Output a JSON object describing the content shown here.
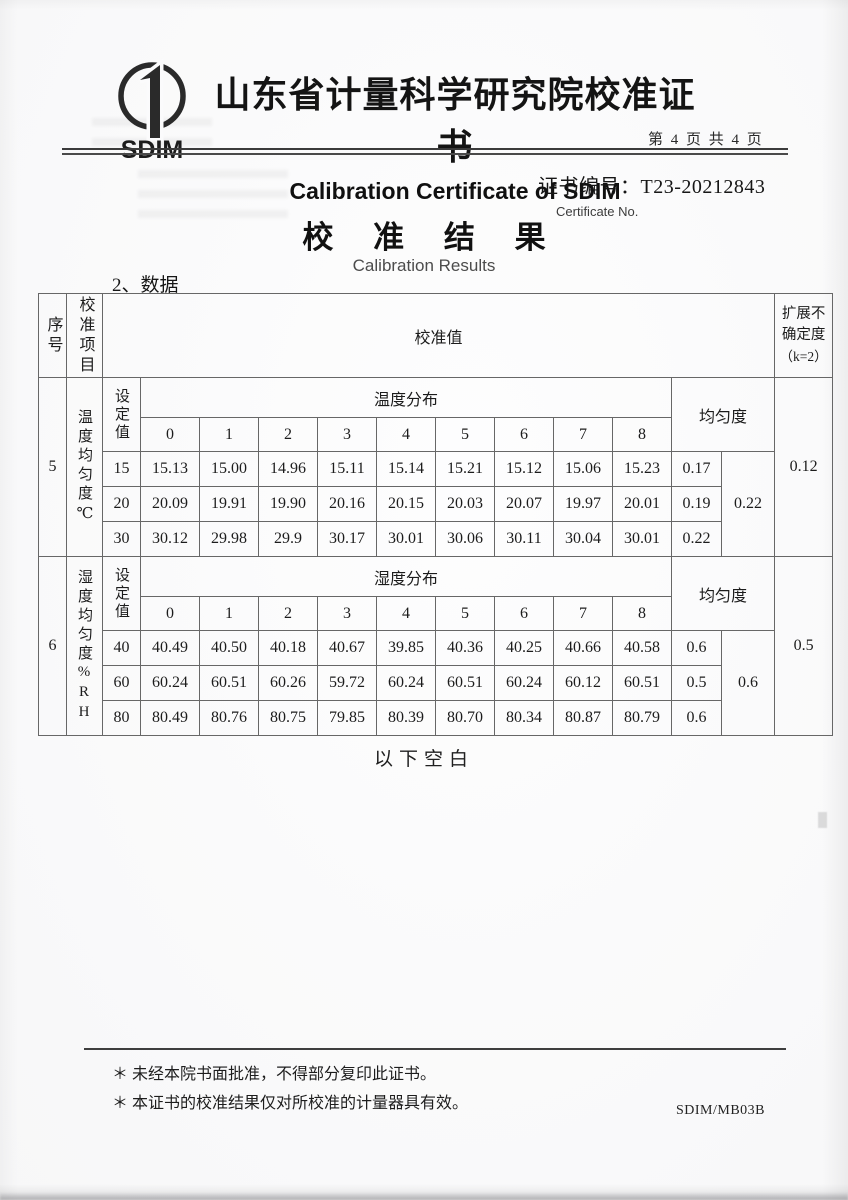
{
  "style_hints": {
    "ink": "#1f1f1f",
    "table_border": "#676767",
    "paper": "#fbfbfc"
  },
  "header": {
    "logo_text": "SDIM",
    "title_cn": "山东省计量科学研究院校准证书",
    "title_en": "Calibration Certificate of SDIM",
    "page_info": "第 4 页 共 4 页",
    "cert_no_label": "证书编号：",
    "cert_no_value": "T23-20212843",
    "cert_no_en": "Certificate No."
  },
  "results": {
    "title_cn": "校 准 结 果",
    "title_en": "Calibration Results",
    "data_label": "2、数据"
  },
  "table": {
    "headers": {
      "seq": "序号",
      "item": "校准项目",
      "value": "校准值",
      "unc_line1": "扩展不",
      "unc_line2": "确定度",
      "unc_line3": "（k=2）"
    },
    "sections": [
      {
        "seq": "5",
        "item": "温度均匀度℃",
        "set_label": "设定值",
        "dist_label": "温度分布",
        "uniformity_label": "均匀度",
        "positions": [
          "0",
          "1",
          "2",
          "3",
          "4",
          "5",
          "6",
          "7",
          "8"
        ],
        "rows": [
          {
            "set": "15",
            "values": [
              "15.13",
              "15.00",
              "14.96",
              "15.11",
              "15.14",
              "15.21",
              "15.12",
              "15.06",
              "15.23"
            ],
            "uniformity": "0.17"
          },
          {
            "set": "20",
            "values": [
              "20.09",
              "19.91",
              "19.90",
              "20.16",
              "20.15",
              "20.03",
              "20.07",
              "19.97",
              "20.01"
            ],
            "uniformity": "0.19"
          },
          {
            "set": "30",
            "values": [
              "30.12",
              "29.98",
              "29.9",
              "30.17",
              "30.01",
              "30.06",
              "30.11",
              "30.04",
              "30.01"
            ],
            "uniformity": "0.22"
          }
        ],
        "overall_uniformity": "0.22",
        "expanded_uncertainty": "0.12"
      },
      {
        "seq": "6",
        "item": "湿度均匀度%RH",
        "set_label": "设定值",
        "dist_label": "湿度分布",
        "uniformity_label": "均匀度",
        "positions": [
          "0",
          "1",
          "2",
          "3",
          "4",
          "5",
          "6",
          "7",
          "8"
        ],
        "rows": [
          {
            "set": "40",
            "values": [
              "40.49",
              "40.50",
              "40.18",
              "40.67",
              "39.85",
              "40.36",
              "40.25",
              "40.66",
              "40.58"
            ],
            "uniformity": "0.6"
          },
          {
            "set": "60",
            "values": [
              "60.24",
              "60.51",
              "60.26",
              "59.72",
              "60.24",
              "60.51",
              "60.24",
              "60.12",
              "60.51"
            ],
            "uniformity": "0.5"
          },
          {
            "set": "80",
            "values": [
              "80.49",
              "80.76",
              "80.75",
              "79.85",
              "80.39",
              "80.70",
              "80.34",
              "80.87",
              "80.79"
            ],
            "uniformity": "0.6"
          }
        ],
        "overall_uniformity": "0.6",
        "expanded_uncertainty": "0.5"
      }
    ]
  },
  "footer": {
    "blank_below": "以下空白",
    "footnote1": "＊ 未经本院书面批准，不得部分复印此证书。",
    "footnote2": "＊ 本证书的校准结果仅对所校准的计量器具有效。",
    "form_code": "SDIM/MB03B"
  }
}
